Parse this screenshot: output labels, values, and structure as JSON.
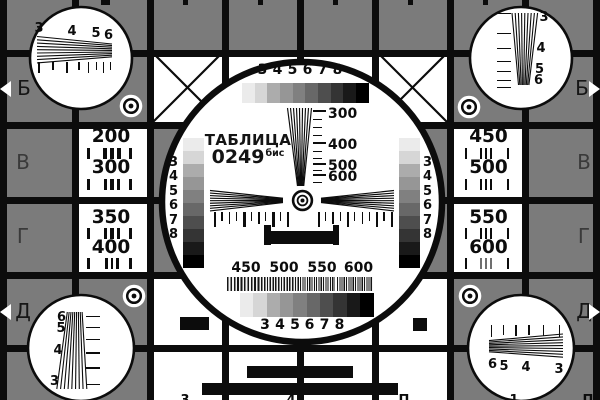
{
  "title_block": {
    "title": "ТАБЛИЦА",
    "code": "0249",
    "suffix": "бис"
  },
  "colors": {
    "background": "#7b7b7b",
    "line": "#0c0c0c",
    "white": "#ffffff",
    "letter_dark": "#161616",
    "letter_mid": "#3a3a3a"
  },
  "grayscale_shades": [
    "#ebebeb",
    "#d6d6d6",
    "#acacac",
    "#969696",
    "#808080",
    "#686868",
    "#4e4e4e",
    "#343434",
    "#191919",
    "#000000"
  ],
  "step_digits": [
    "3",
    "4",
    "5",
    "6",
    "7",
    "8"
  ],
  "vertical_scale_labels": [
    "300",
    "400",
    "500",
    "600"
  ],
  "burst_scale_labels": [
    "450",
    "500",
    "550",
    "600"
  ],
  "left_panel_labels": [
    "200",
    "300",
    "350",
    "400"
  ],
  "right_panel_labels": [
    "450",
    "500",
    "550",
    "600"
  ],
  "row_letters_left": [
    "Б",
    "В",
    "Г",
    "Д"
  ],
  "row_letters_right": [
    "Б",
    "В",
    "Г",
    "Д"
  ],
  "corner_digits": {
    "top_left": [
      "3",
      "4",
      "5",
      "6"
    ],
    "top_right": [
      "3",
      "4",
      "5",
      "6"
    ],
    "bottom_left": [
      "6",
      "5",
      "4",
      "3"
    ],
    "bottom_right": [
      "6",
      "5",
      "4",
      "3"
    ]
  },
  "edge_glyphs_bottom": [
    "3",
    "4",
    "П",
    "1",
    "П"
  ]
}
